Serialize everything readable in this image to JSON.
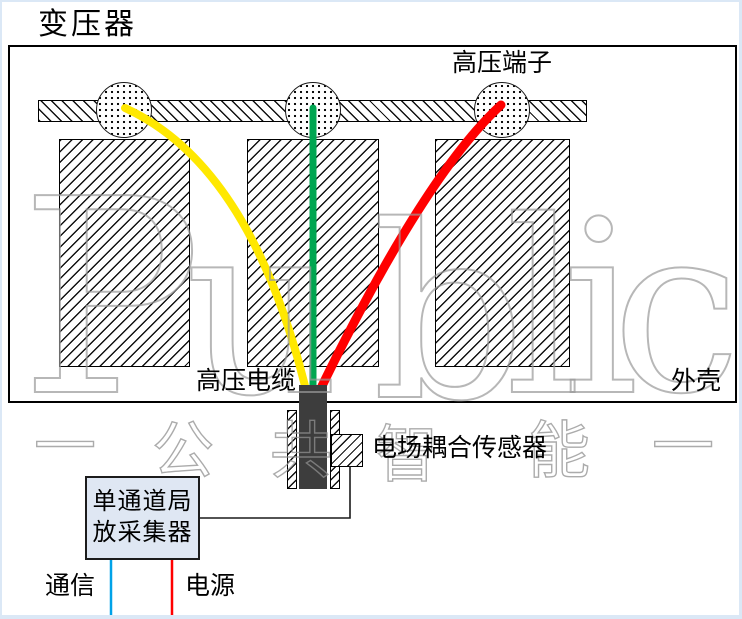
{
  "title": "变压器",
  "labels": {
    "terminal": "高压端子",
    "cable": "高压电缆",
    "enclosure": "外壳",
    "sensor": "电场耦合传感器",
    "comm": "通信",
    "power": "电源"
  },
  "collector": {
    "line1": "单通道局",
    "line2": "放采集器"
  },
  "watermark": {
    "letters": [
      "P",
      "u",
      "b",
      "l",
      "i",
      "c"
    ],
    "cjk": [
      "一",
      "公",
      "共",
      "智",
      "能",
      "一"
    ]
  },
  "colors": {
    "cable_yellow": "#FFE800",
    "cable_green": "#00A651",
    "cable_red": "#FF0000",
    "comm_blue": "#00A2E8",
    "power_red": "#FF0000",
    "wire_black": "#1a1a1a"
  }
}
